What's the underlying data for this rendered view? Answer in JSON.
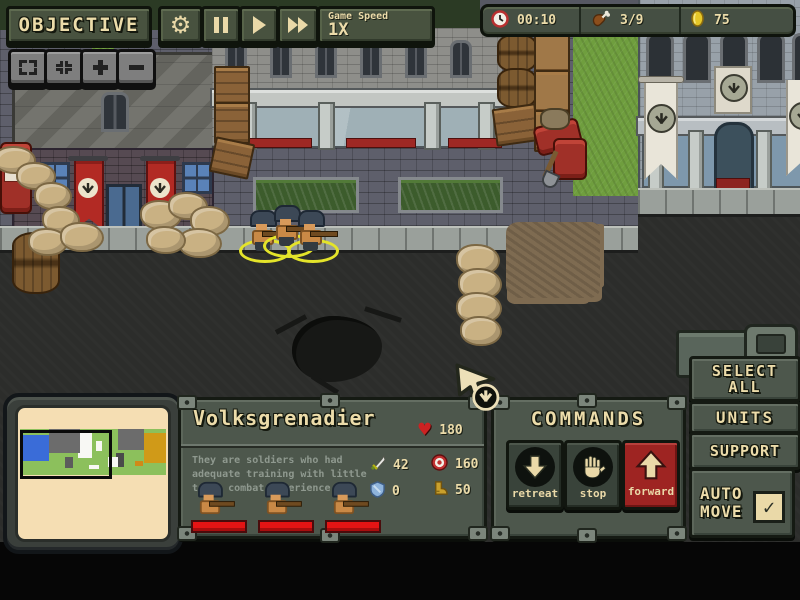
{
  "toolbar": {
    "objective": "OBJECTIVE",
    "game_speed_label": "Game Speed",
    "game_speed_value": "1X"
  },
  "icons": {
    "gear": "⚙",
    "heart": "♥",
    "check": "✓"
  },
  "resources": {
    "time": "00:10",
    "rations": "3/9",
    "gold": "75"
  },
  "unit_panel": {
    "name": "Volksgrenadier",
    "health": "180",
    "desc_line1": "They are soldiers who had",
    "desc_line2": "adequate training with little",
    "desc_line3": "to no combat experience",
    "attack": "42",
    "range": "160",
    "defense": "0",
    "speed": "50",
    "unit_count": 3
  },
  "commands": {
    "title": "COMMANDS",
    "retreat_label": "retreat",
    "stop_label": "stop",
    "forward_label": "forward"
  },
  "side_panel": {
    "select_all_1": "SELECT",
    "select_all_2": "ALL",
    "units": "UNITS",
    "support": "SUPPORT",
    "auto_1": "AUTO",
    "auto_2": "MOVE"
  },
  "minimap": {
    "bg": "#8cc05c",
    "blocks": [
      {
        "x": 2,
        "y": 12,
        "w": 18,
        "h": 58,
        "c": "#3a6cd8"
      },
      {
        "x": 20,
        "y": 0,
        "w": 21,
        "h": 52,
        "c": "#6c6c6c"
      },
      {
        "x": 40,
        "y": 4,
        "w": 9,
        "h": 58,
        "c": "#f8f8f4"
      },
      {
        "x": 52,
        "y": 26,
        "w": 4,
        "h": 22,
        "c": "#f8f8f4"
      },
      {
        "x": 31,
        "y": 60,
        "w": 5,
        "h": 24,
        "c": "#5c5c5c"
      },
      {
        "x": 60,
        "y": 60,
        "w": 7,
        "h": 22,
        "c": "#f8f8f4"
      },
      {
        "x": 67,
        "y": 0,
        "w": 18,
        "h": 46,
        "c": "#6c6c6c"
      },
      {
        "x": 66,
        "y": 52,
        "w": 5,
        "h": 30,
        "c": "#4a4a4a"
      },
      {
        "x": 85,
        "y": 8,
        "w": 15,
        "h": 66,
        "c": "#d09a18"
      },
      {
        "x": 79,
        "y": 70,
        "w": 5,
        "h": 10,
        "c": "#d08a18"
      },
      {
        "x": 47,
        "y": 78,
        "w": 7,
        "h": 10,
        "c": "#f8f8f4"
      }
    ],
    "viewport": {
      "x": 0,
      "y": 2,
      "w": 59,
      "h": 94
    }
  },
  "colors": {
    "ui_green": "#4d574c",
    "ui_dark_border": "#151a13",
    "cream_text": "#ecdcaa",
    "accent_red": "#a02522",
    "selection_yellow": "#e4e42a",
    "road_gray": "#2c2d2b",
    "grass_green": "#6f9e3e",
    "sandbag_tan": "#c9b183",
    "health_red": "#e41414",
    "minimap_paper": "#f5deb3"
  }
}
